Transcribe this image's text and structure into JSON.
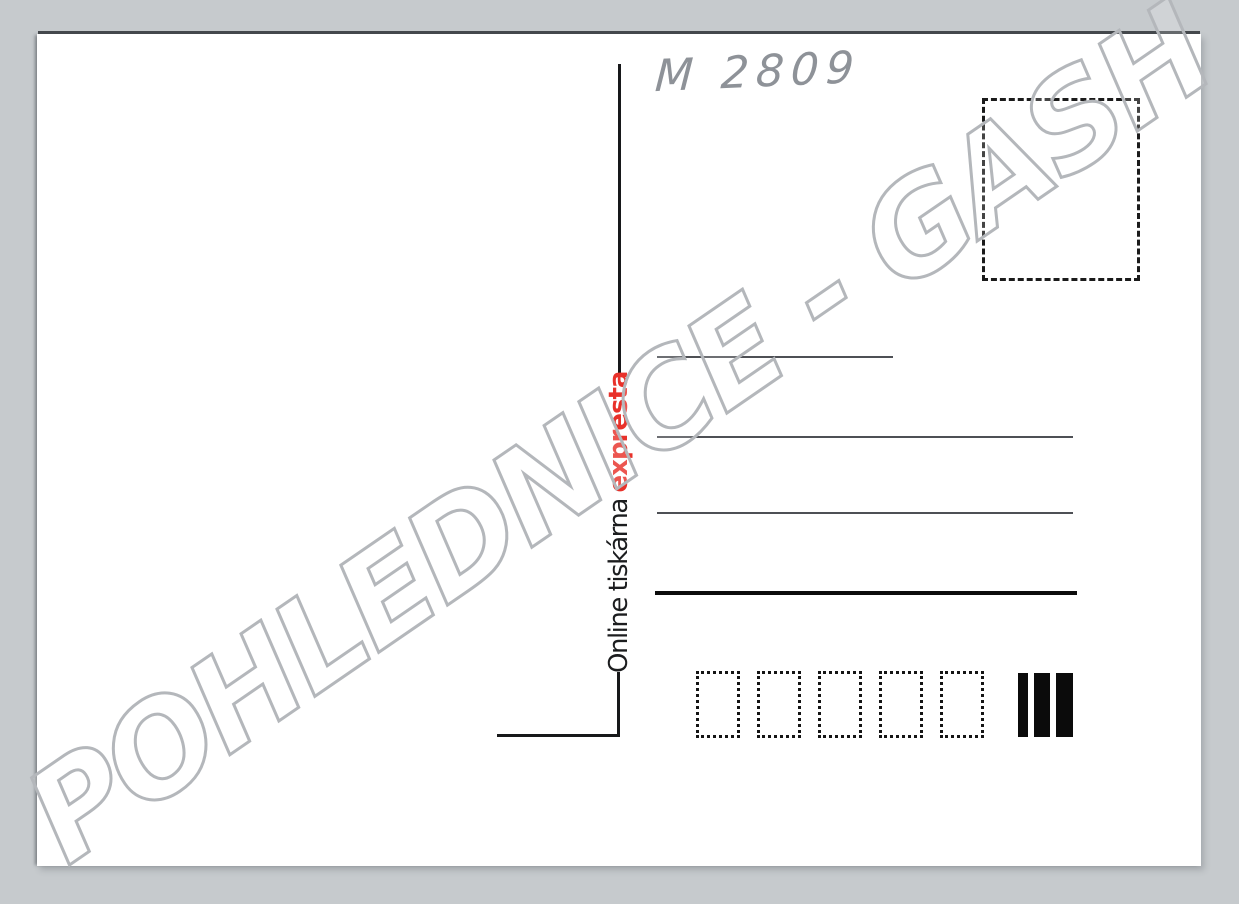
{
  "watermark": {
    "text": "POHLEDNICE - GASH",
    "outline_color": "#b4b7bb"
  },
  "postcard": {
    "handwritten_note": "M 2809",
    "printer_credit": {
      "prefix": "Online tiskárna ",
      "brand": "expresta",
      "brand_color": "#e8312a"
    },
    "address_lines": {
      "count": 4,
      "thick_last_line": true
    },
    "postal_code_boxes": {
      "count": 5
    },
    "franking_bars": {
      "count": 3,
      "widths_px": [
        10,
        16,
        17
      ]
    }
  },
  "colors": {
    "background": "#c6cacd",
    "card": "#ffffff",
    "ink_black": "#101010",
    "pencil_gray": "#8e9298"
  }
}
